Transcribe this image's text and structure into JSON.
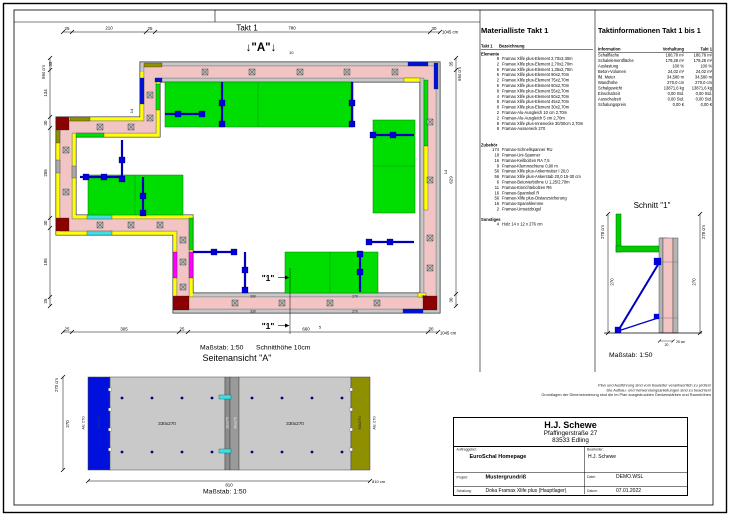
{
  "page": {
    "takt_header": "Takt 1"
  },
  "colors": {
    "wall_concrete": "#f2c4c4",
    "platform_green": "#00dd00",
    "element_yellow": "#ffff00",
    "brace_blue": "#0000cc",
    "corner_darkred": "#8b0000",
    "ausgleich_cyan": "#40e0e0",
    "ausgleich_magenta": "#ff00ff",
    "panel_gray": "#c9c9c9",
    "panel_blue": "#0011dd",
    "panel_olive": "#8f8f00"
  },
  "plan": {
    "marker_a": "↓\"A\"↓",
    "marker_a_sub": "10",
    "marker_1": "\"1\"",
    "scale_label": "Maßstab: 1:50",
    "schnitthoehe": "Schnitthöhe 10cm",
    "dims": {
      "top": [
        "25",
        "210",
        "25",
        "780",
        "30"
      ],
      "top_total": "1045 cm",
      "bottom": [
        "25",
        "305",
        "25",
        "660",
        "30"
      ],
      "bottom_total": "1045 cm",
      "left": [
        "35",
        "134",
        "30",
        "255",
        "30",
        "195",
        "25"
      ],
      "left_total": "694 cm",
      "right": [
        "35",
        "629",
        "30"
      ],
      "right_total": "694 cm",
      "d14a": "14",
      "d14b": "14",
      "d5": "5",
      "strip": [
        "330",
        "270",
        "330",
        "270",
        "150"
      ]
    }
  },
  "side_view": {
    "title": "Seitenansicht \"A\"",
    "labels": {
      "left_out": "AE 270",
      "left_in": "60x270",
      "panel1": "330x270",
      "strip1": "10x270",
      "strip2": "30x270",
      "panel2": "330x270",
      "right_in": "50x270",
      "right_out": "AE 270"
    },
    "dims": {
      "h_total": "270 cm",
      "h": "270",
      "w": "810",
      "w_total": "810 cm"
    },
    "scale_label": "Maßstab: 1:50"
  },
  "schnitt": {
    "title": "Schnitt \"1\"",
    "dims": {
      "left_total": "278 cm",
      "left_inner": "270",
      "right_total": "278 cm",
      "right_inner": "270",
      "base_w": "20",
      "base_label": "25 cm"
    },
    "scale_label": "Maßstab: 1:50"
  },
  "materialliste": {
    "title": "Materialliste Takt 1",
    "col_qty": "Takt 1",
    "col_name": "Bezeichnung",
    "sec1_name": "Elemente",
    "sec1": [
      {
        "qty": "8",
        "name": "Framax Xlife plus-Element 2,70x3,30m"
      },
      {
        "qty": "2",
        "name": "Framax Xlife plus-Element 2,70x2,70m"
      },
      {
        "qty": "6",
        "name": "Framax Xlife plus-Element 1,35x2,70m"
      },
      {
        "qty": "6",
        "name": "Framax Xlife plus-Element 90x2,70m"
      },
      {
        "qty": "2",
        "name": "Framax Xlife plus-Element 75x2,70m"
      },
      {
        "qty": "6",
        "name": "Framax Xlife plus-Element 60x2,70m"
      },
      {
        "qty": "8",
        "name": "Framax Xlife plus-Element 55x2,70m"
      },
      {
        "qty": "4",
        "name": "Framax Xlife plus-Element 50x2,70m"
      },
      {
        "qty": "8",
        "name": "Framax Xlife plus-Element 45x2,70m"
      },
      {
        "qty": "8",
        "name": "Framax Xlife plus-Element 30x2,70m"
      },
      {
        "qty": "2",
        "name": "Framax-Alu-Ausgleich 10 cm 2,70m"
      },
      {
        "qty": "2",
        "name": "Framax-Alu-Ausgleich 5 cm 2,70m"
      },
      {
        "qty": "8",
        "name": "Framax Xlife plus-Innenecke 30/30cm 2,70m"
      },
      {
        "qty": "8",
        "name": "Framax-Ausseneck 270"
      }
    ],
    "sec2_name": "Zubehör",
    "sec2": [
      {
        "qty": "174",
        "name": "Framax-Schnellspanner RU"
      },
      {
        "qty": "18",
        "name": "Framax-Uni-Spanner"
      },
      {
        "qty": "16",
        "name": "Framax-Keilbolzen RA 7,5"
      },
      {
        "qty": "9",
        "name": "Framax-Klemmschiene 0,90 m"
      },
      {
        "qty": "56",
        "name": "Framax Xlife plus-Ankermutter I 20,0"
      },
      {
        "qty": "56",
        "name": "Framax Xlife plus-Ankerstab 20,0 15-30 cm"
      },
      {
        "qty": "6",
        "name": "Framax-Betonierbühne U 1,25/2,70m"
      },
      {
        "qty": "11",
        "name": "Framax-Einrichtebolzen R6"
      },
      {
        "qty": "16",
        "name": "Framax-Spannkeil R"
      },
      {
        "qty": "56",
        "name": "Framax-Xlife plus-Distanzsicherung"
      },
      {
        "qty": "16",
        "name": "Framax-Spannklemme"
      },
      {
        "qty": "2",
        "name": "Framax-Umsetzbügel"
      }
    ],
    "sec3_name": "Sonstiges",
    "sec3": [
      {
        "qty": "4",
        "name": "Holz 14 x 12 x 276 cm"
      }
    ]
  },
  "taktinfo": {
    "title": "Taktinformationen Takt 1 bis 1",
    "columns": [
      "Information",
      "Vorhaltung",
      "Takt 1"
    ],
    "rows": [
      {
        "label": "Schalfläche",
        "v1": "180,78 m²",
        "v2": "180,78 m²"
      },
      {
        "label": "Schalelementfläche",
        "v1": "179,28 m²",
        "v2": "179,28 m²"
      },
      {
        "label": "Auslastung",
        "v1": "100 %",
        "v2": "100 %"
      },
      {
        "label": "Beton-Volumen",
        "v1": "24,02 m³",
        "v2": "24,02 m³"
      },
      {
        "label": "lfd. Meter",
        "v1": "34,580 m",
        "v2": "34,580 m"
      },
      {
        "label": "Wandhöhe",
        "v1": "270,0 cm",
        "v2": "270,0 cm"
      },
      {
        "label": "Schalgewicht",
        "v1": "13871,6 kg",
        "v2": "13871,6 kg"
      },
      {
        "label": "Einschalzeit",
        "v1": "0,00 Std.",
        "v2": "0,00 Std."
      },
      {
        "label": "Ausschalzeit",
        "v1": "0,00 Std.",
        "v2": "0,00 Std."
      },
      {
        "label": "Schalungspreis",
        "v1": "0,00 €",
        "v2": "0,00 €"
      }
    ]
  },
  "notes": [
    "Plan und Ausführung sind vom Bauleiter verantwortlich zu prüfen!",
    "Die Aufbau- und Verwendungsanleitungen sind zu beachten!",
    "Grundlagen der Dimensionierung sind die im Plan ausgedruckten Deckenstärken und Raumhöhen"
  ],
  "titleblock": {
    "company": "H.J. Schewe",
    "address1": "Pfaffingerstraße 27",
    "address2": "83533 Edling",
    "auftraggeber_label": "Auftraggeber:",
    "auftraggeber": "EuroSchal Homepage",
    "bearbeiter_label": "Bearbeiter:",
    "bearbeiter": "H.J. Schewe",
    "projekt_label": "Projekt:",
    "projekt": "Mustergrundriß",
    "datei_label": "Datei:",
    "datei": "DEMO.WSL",
    "schalung_label": "Schalung:",
    "schalung": "Doka Framax Xlife plus (Hauptlager)",
    "datum_label": "Datum:",
    "datum": "07.01.2022"
  }
}
